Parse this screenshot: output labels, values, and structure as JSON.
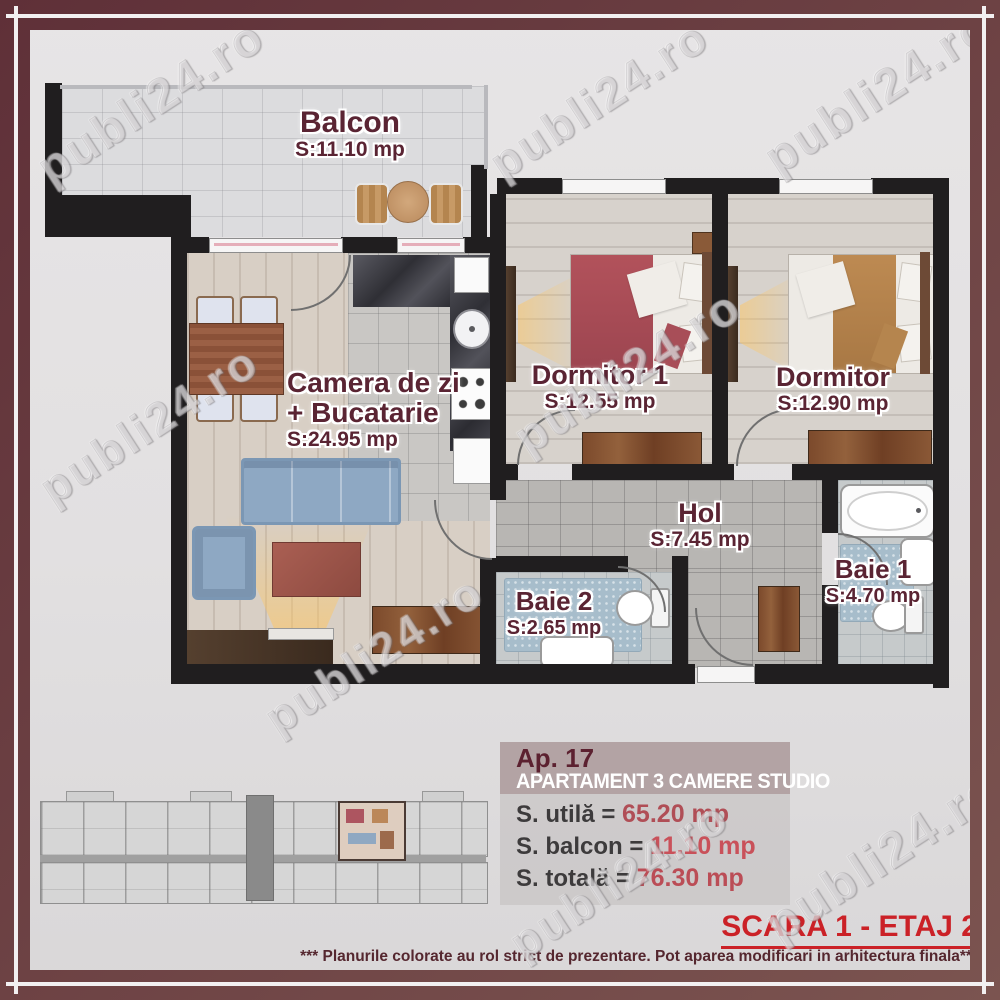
{
  "watermark": {
    "text": "publi24.ro"
  },
  "rooms": {
    "balcon": {
      "name": "Balcon",
      "area": "S:11.10 mp"
    },
    "living": {
      "line1": "Camera de zi",
      "line2": "+ Bucatarie",
      "area": "S:24.95 mp"
    },
    "dormitor1": {
      "name": "Dormitor 1",
      "area": "S:12.55 mp"
    },
    "dormitor2": {
      "name": "Dormitor",
      "area": "S:12.90 mp"
    },
    "hol": {
      "name": "Hol",
      "area": "S:7.45 mp"
    },
    "baie2": {
      "name": "Baie 2",
      "area": "S:2.65 mp"
    },
    "baie1": {
      "name": "Baie 1",
      "area": "S:4.70 mp"
    }
  },
  "info_panel": {
    "apartment_no": "Ap. 17",
    "title": "APARTAMENT 3 CAMERE STUDIO",
    "lines": [
      {
        "label": "S. utilă = ",
        "value": "65.20 mp"
      },
      {
        "label": "S. balcon = ",
        "value": "11.10 mp"
      },
      {
        "label": "S. totală = ",
        "value": "76.30 mp"
      }
    ]
  },
  "footer": {
    "scara": "SCARA 1 - ETAJ 2",
    "disclaimer": "*** Planurile colorate au rol strict de prezentare. Pot aparea modificari in arhitectura finala***"
  },
  "colors": {
    "frame-dark": "#5f3038",
    "frame-light": "#7b5450",
    "accent-red": "#cb2127",
    "maroon-text": "#5a2433",
    "panel-header": "#b3a3a4",
    "value-utila": "#b04e56",
    "value-balcon": "#c9515a",
    "value-totala": "#bb4d56",
    "wall": "#201e1f"
  }
}
